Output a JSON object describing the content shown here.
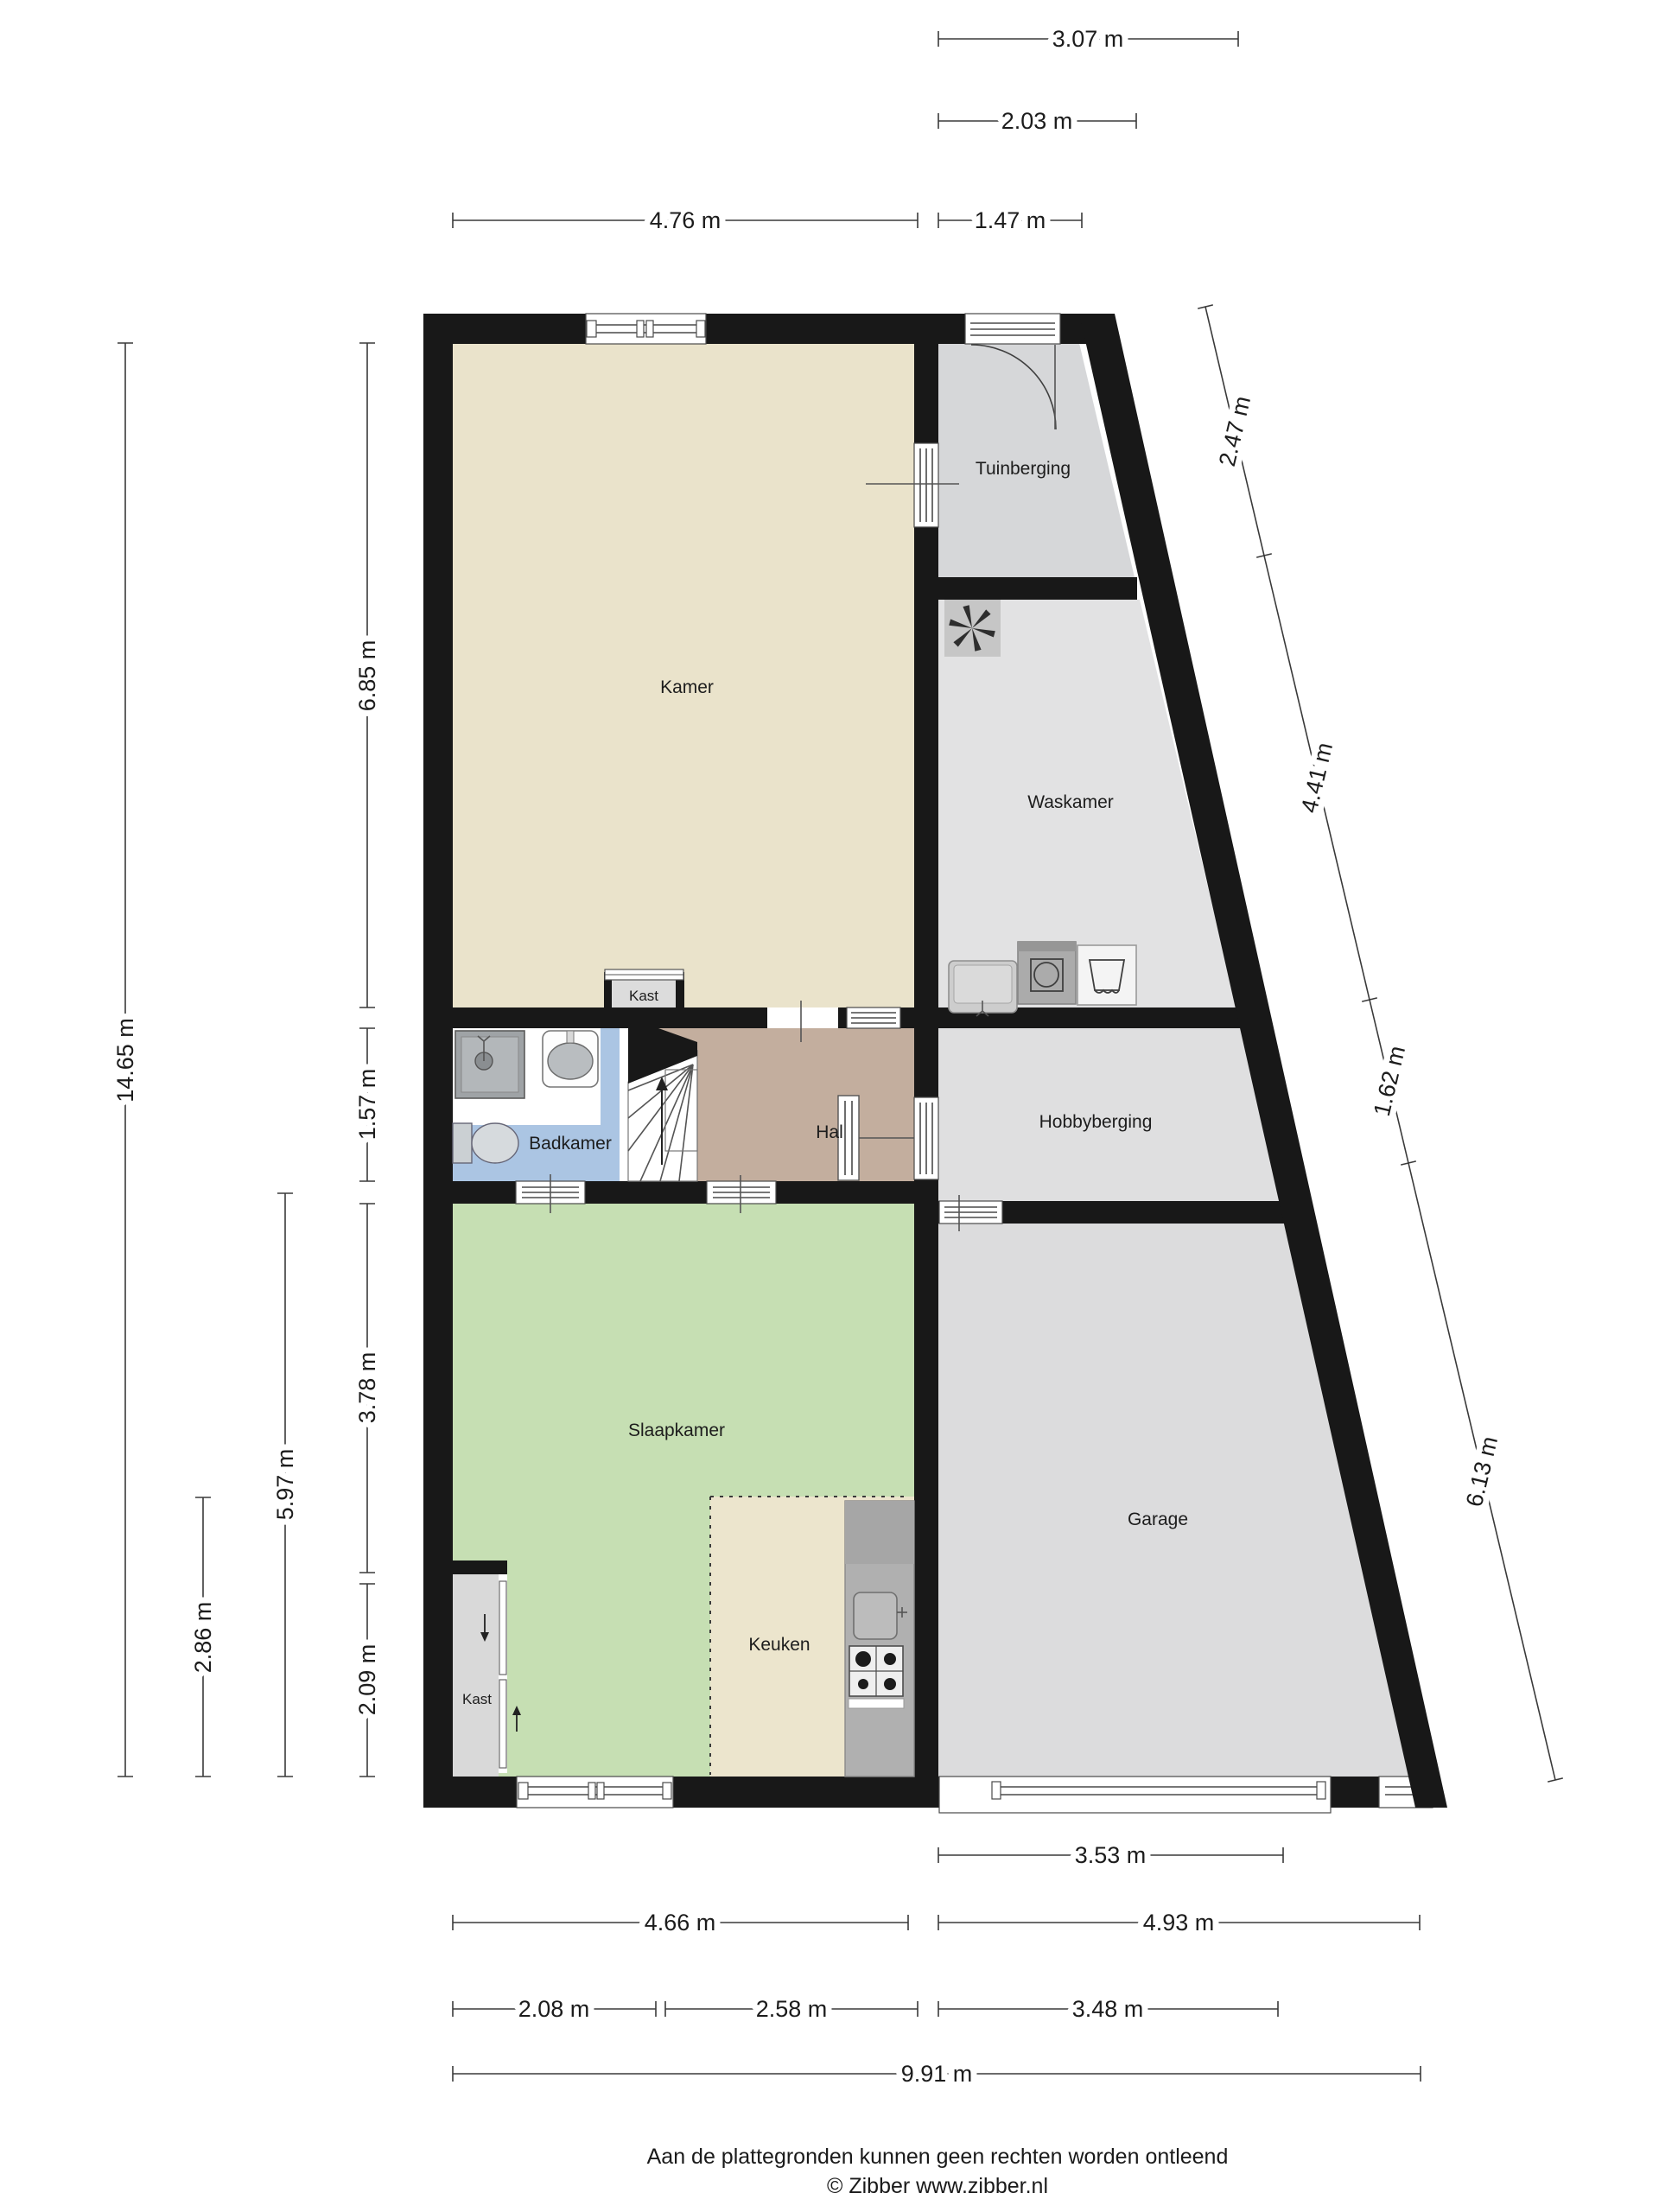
{
  "plan": {
    "rooms": [
      {
        "id": "kamer",
        "label": "Kamer",
        "color": "#eae3cb"
      },
      {
        "id": "tuinberging",
        "label": "Tuinberging",
        "color": "#d6d7d9"
      },
      {
        "id": "waskamer",
        "label": "Waskamer",
        "color": "#e2e2e3"
      },
      {
        "id": "hobbyberging",
        "label": "Hobbyberging",
        "color": "#dfdfe0"
      },
      {
        "id": "garage",
        "label": "Garage",
        "color": "#dcdcdd"
      },
      {
        "id": "badkamer",
        "label": "Badkamer",
        "color": "#abc5e3"
      },
      {
        "id": "hal",
        "label": "Hal",
        "color": "#c3ae9e"
      },
      {
        "id": "slaapkamer",
        "label": "Slaapkamer",
        "color": "#c6dfb3"
      },
      {
        "id": "keuken",
        "label": "Keuken",
        "color": "#ece5cd"
      },
      {
        "id": "kast-boven",
        "label": "Kast",
        "color": "#dcdcdc"
      },
      {
        "id": "kast-onder",
        "label": "Kast",
        "color": "#d9d9d9"
      }
    ],
    "dims": {
      "top": [
        "3.07 m",
        "2.03 m",
        "4.76 m",
        "1.47 m"
      ],
      "left": [
        "14.65 m",
        "6.85 m",
        "1.57 m",
        "3.78 m",
        "2.09 m",
        "5.97 m",
        "2.86 m"
      ],
      "right": [
        "2.47 m",
        "4.41 m",
        "1.62 m",
        "6.13 m"
      ],
      "bottom": [
        "3.53 m",
        "4.66 m",
        "4.93 m",
        "2.08 m",
        "2.58 m",
        "3.48 m",
        "9.91 m"
      ]
    },
    "wall_color": "#181818",
    "icons": [
      "ventilation-fan-icon",
      "washing-machine-icon",
      "dryer-basket-icon",
      "utility-sink-icon",
      "shower-icon",
      "washbasin-icon",
      "toilet-icon",
      "stairs-icon",
      "door-arc-icon",
      "stove-icon",
      "kitchen-sink-icon",
      "closet-door-icon"
    ]
  },
  "footer": {
    "disclaimer": "Aan de plattegronden kunnen geen rechten worden ontleend",
    "credit": "© Zibber www.zibber.nl"
  }
}
